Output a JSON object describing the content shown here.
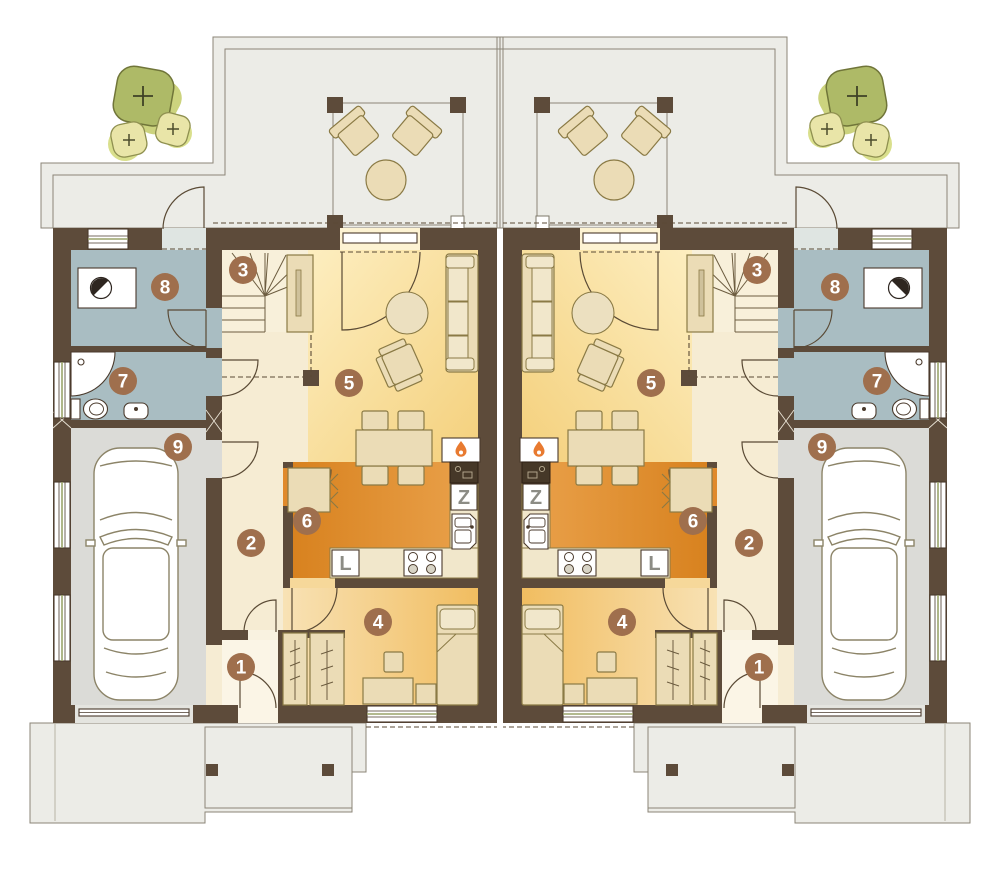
{
  "plan": {
    "room_labels": [
      "1",
      "2",
      "3",
      "4",
      "5",
      "6",
      "7",
      "8",
      "9"
    ],
    "appliance_labels": {
      "fridge": "L",
      "dishwasher": "Z"
    }
  },
  "colors": {
    "wall": "#5d4b3a",
    "paving": "#ecece7",
    "living_floor": "#f5d27f",
    "kitchen_floor": "#e08a2c",
    "bedroom_floor": "#f1bd60",
    "hall_floor": "#f7eed7",
    "wet_room_floor": "#a9bdc2",
    "garage_floor": "#dbdbd7",
    "label_circle": "#9f6f4d",
    "appliance_letter": "#8c8c85",
    "flame_accent": "#e87a30",
    "tree_olive": "#aeba67",
    "tree_pale": "#e9e5a8",
    "furniture": "#ebdcb6"
  }
}
